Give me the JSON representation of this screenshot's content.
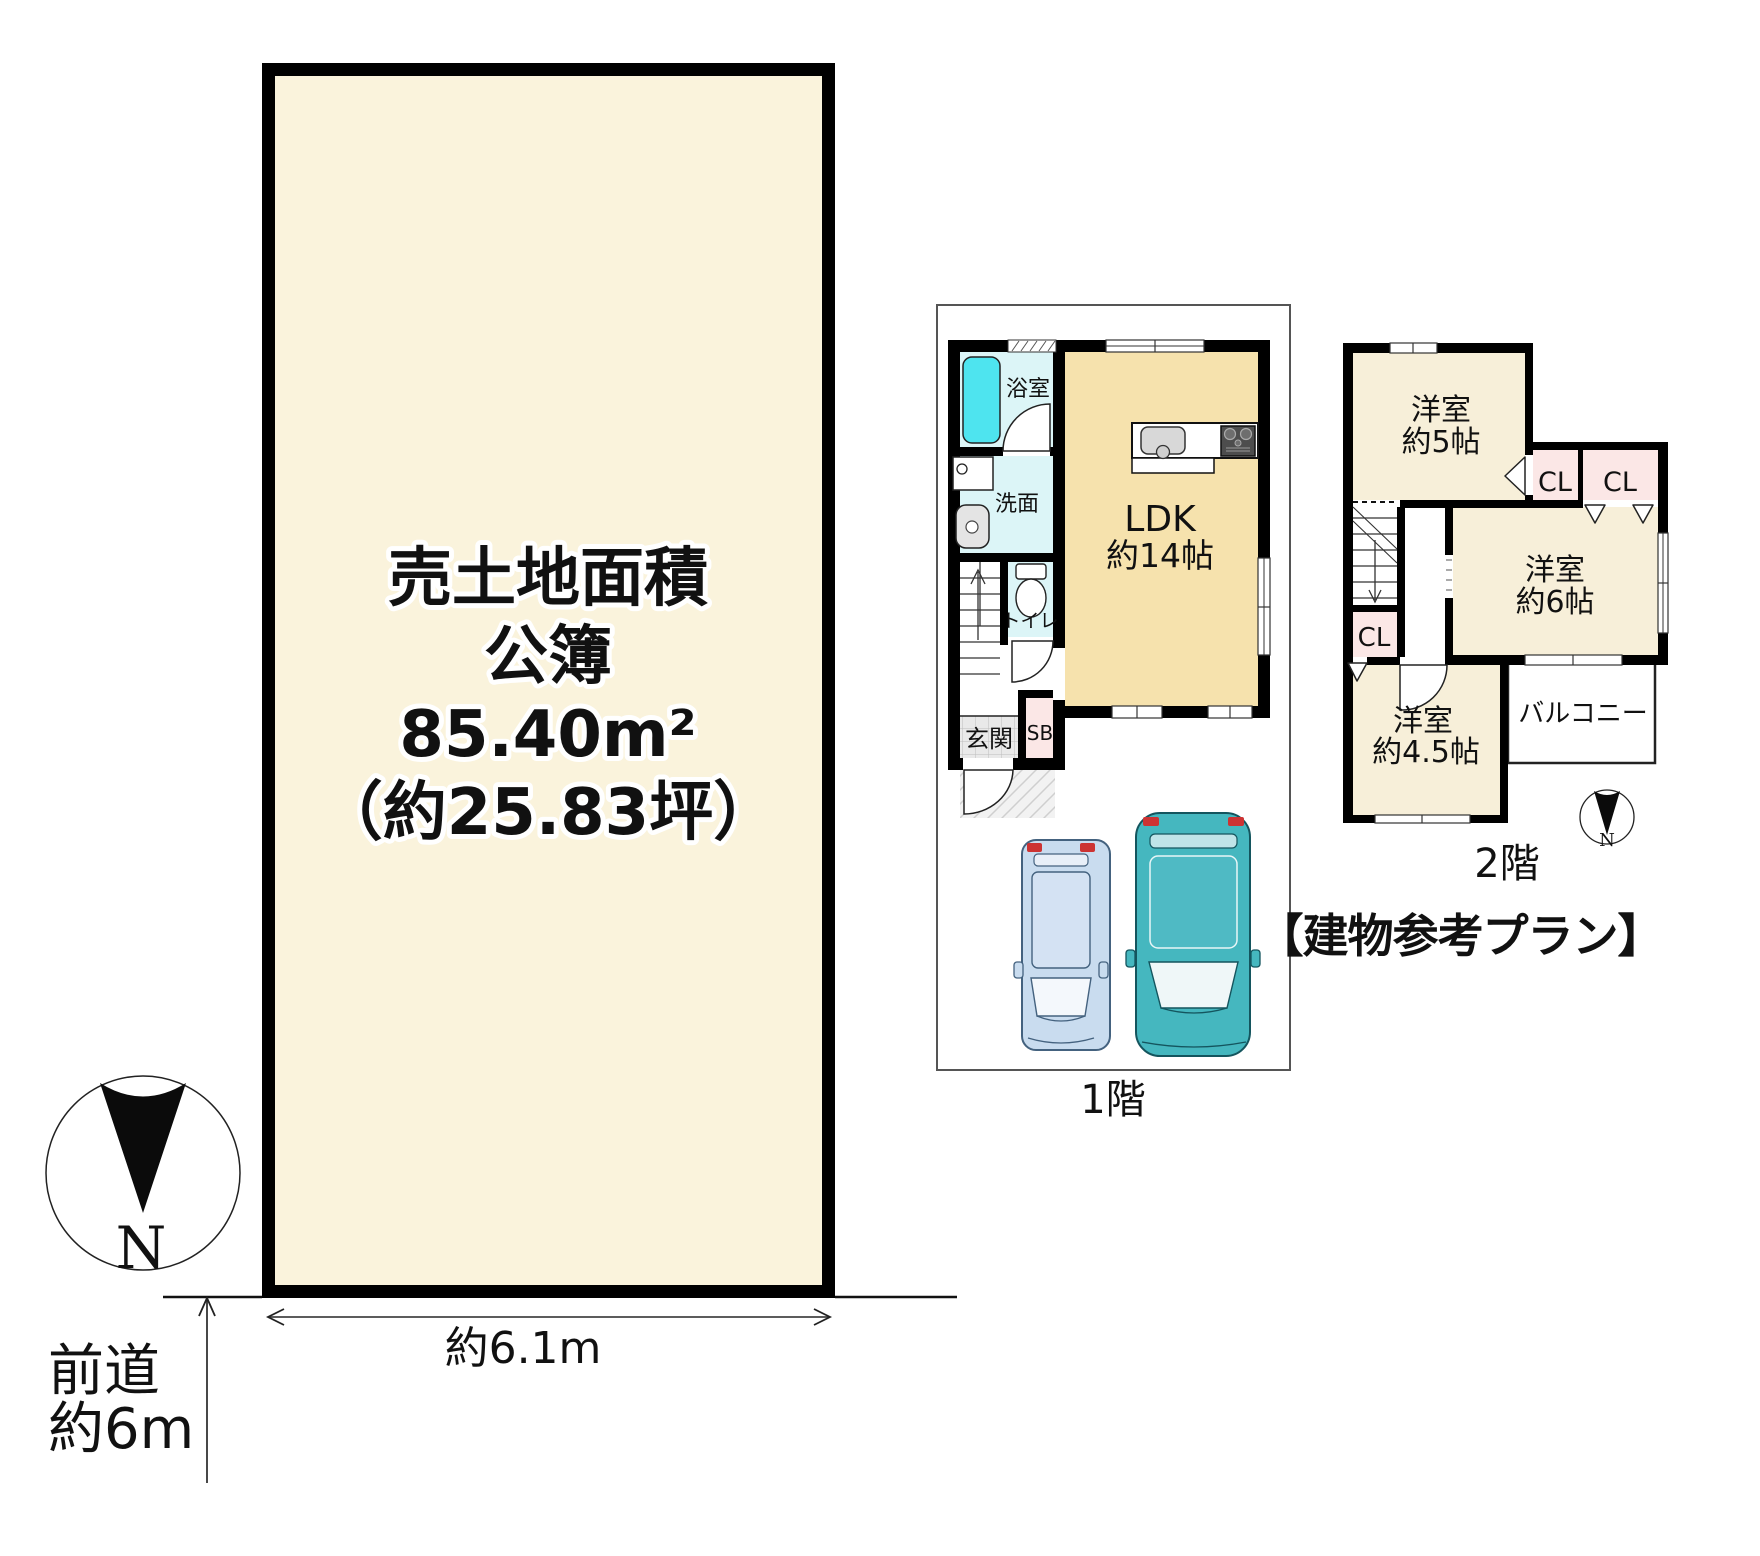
{
  "colors": {
    "land_fill": "#FAF3DC",
    "ldk_floor": "#F6E2AD",
    "room_floor": "#F7EFD9",
    "wet_floor": "#DCF5F7",
    "tub": "#4EE4EF",
    "closet": "#FBE7E6",
    "entrance_tile": "#E9E9E9",
    "car_blue": "#C9DCEF",
    "car_teal": "#45B7BF",
    "wall": "#000000"
  },
  "land": {
    "area_line1": "売土地面積",
    "area_line2": "公簿",
    "area_line3": "85.40m²",
    "area_line4": "（約25.83坪）",
    "frontage": "約6.1m",
    "road_line1": "前道",
    "road_line2": "約6m",
    "north": "N"
  },
  "floor1": {
    "caption": "1階",
    "bath": "浴室",
    "wash": "洗面",
    "toilet": "トイレ",
    "entrance": "玄関",
    "shoe_box": "SB",
    "ldk_line1": "LDK",
    "ldk_line2": "約14帖"
  },
  "floor2": {
    "caption": "2階",
    "north": "N",
    "room5_line1": "洋室",
    "room5_line2": "約5帖",
    "room6_line1": "洋室",
    "room6_line2": "約6帖",
    "room45_line1": "洋室",
    "room45_line2": "約4.5帖",
    "closet1": "CL",
    "closet2": "CL",
    "closet3": "CL",
    "balcony": "バルコニー"
  },
  "title": "【建物参考プラン】"
}
